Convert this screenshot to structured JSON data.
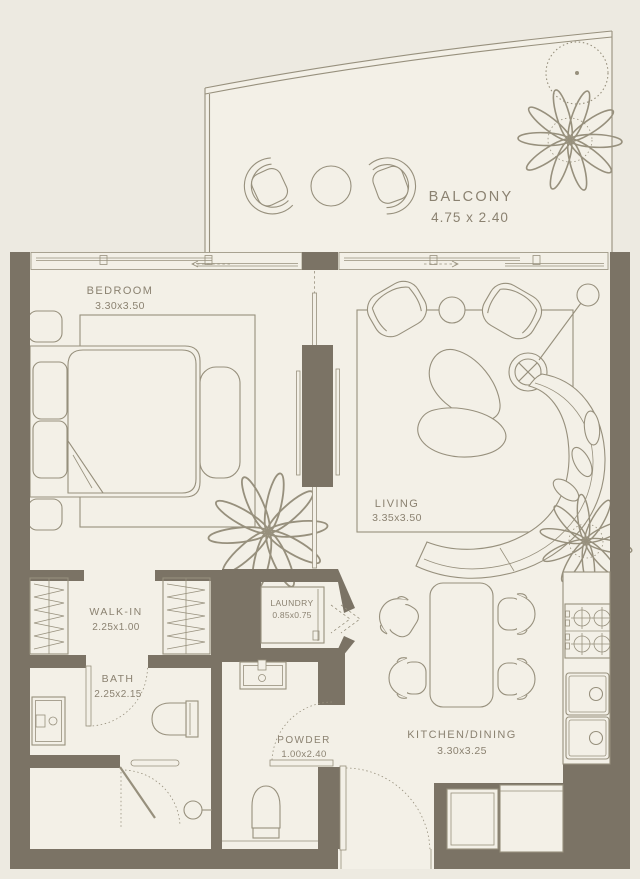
{
  "palette": {
    "background": "#edeae1",
    "floor": "#f3f0e7",
    "wall": "#7b7365",
    "line": "#97907d",
    "text": "#8b8271"
  },
  "rooms": {
    "balcony": {
      "label": "BALCONY",
      "dims": "4.75 x 2.40"
    },
    "bedroom": {
      "label": "BEDROOM",
      "dims": "3.30x3.50"
    },
    "living": {
      "label": "LIVING",
      "dims": "3.35x3.50"
    },
    "walk_in": {
      "label": "WALK-IN",
      "dims": "2.25x1.00"
    },
    "laundry": {
      "label": "LAUNDRY",
      "dims": "0.85x0.75"
    },
    "bath": {
      "label": "BATH",
      "dims": "2.25x2.15"
    },
    "powder": {
      "label": "POWDER",
      "dims": "1.00x2.40"
    },
    "kitchen_dining": {
      "label": "KITCHEN/DINING",
      "dims": "3.30x3.25"
    }
  },
  "symbols": [
    "tree",
    "plant",
    "lounge-chair",
    "round-table",
    "sliding-window",
    "bed",
    "pillow",
    "nightstand",
    "bench",
    "rug",
    "tv",
    "media-wall",
    "armchair",
    "side-table",
    "floor-lamp",
    "coffee-table",
    "curved-sofa",
    "sofa-cushion",
    "wardrobe-hangers",
    "laundry-machine",
    "bifold-door",
    "vanity-sink",
    "toilet",
    "shower",
    "towel-rail",
    "door-swing",
    "dining-table",
    "dining-chair",
    "stove",
    "kitchen-sink",
    "fridge",
    "counter"
  ]
}
